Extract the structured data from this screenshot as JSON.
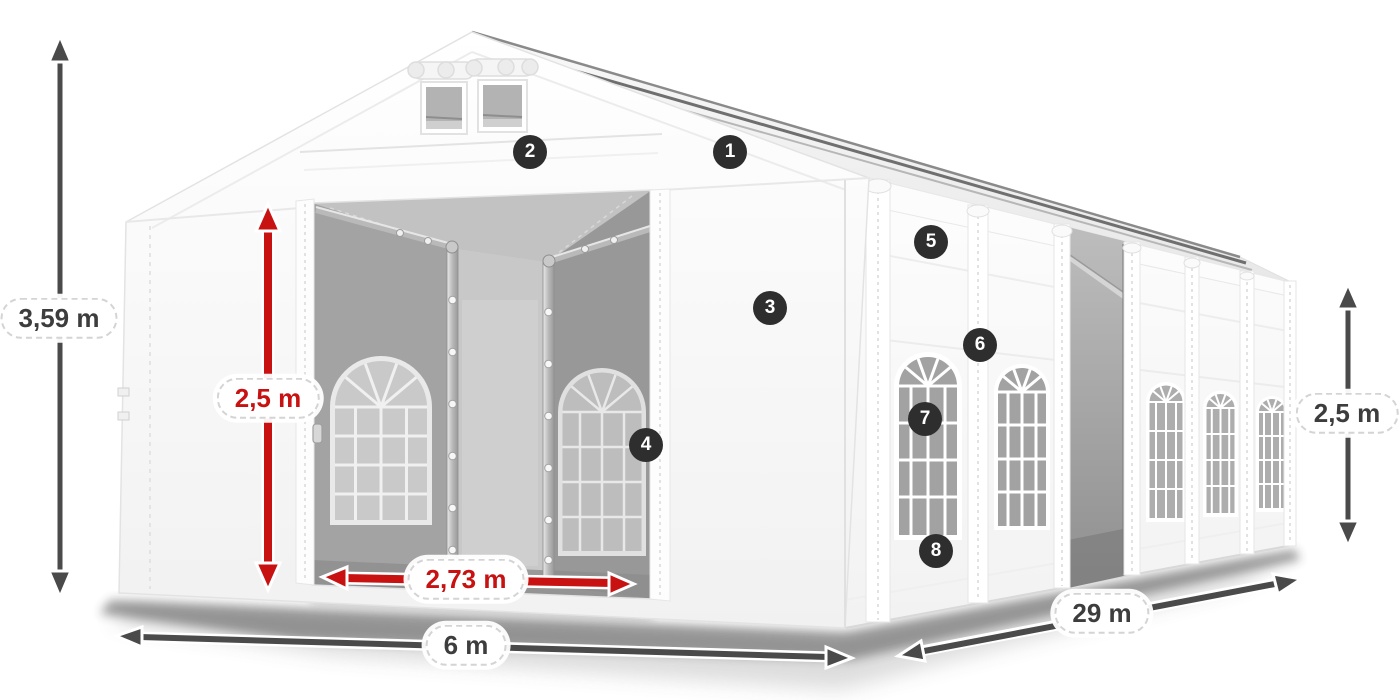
{
  "diagram": {
    "dimensions": {
      "total_height": "3,59 m",
      "door_height": "2,5 m",
      "door_width": "2,73 m",
      "width": "6 m",
      "length": "29 m",
      "side_height": "2,5 m"
    },
    "markers": [
      {
        "number": "1"
      },
      {
        "number": "2"
      },
      {
        "number": "3"
      },
      {
        "number": "4"
      },
      {
        "number": "5"
      },
      {
        "number": "6"
      },
      {
        "number": "7"
      },
      {
        "number": "8"
      }
    ],
    "colors": {
      "dimension_primary": "#4a4a4a",
      "dimension_accent": "#c81212",
      "marker_background": "#2e2e2e",
      "marker_text": "#ffffff",
      "label_background": "#ffffff",
      "label_border": "#d4d4d4",
      "canvas_background": "#ffffff"
    }
  }
}
